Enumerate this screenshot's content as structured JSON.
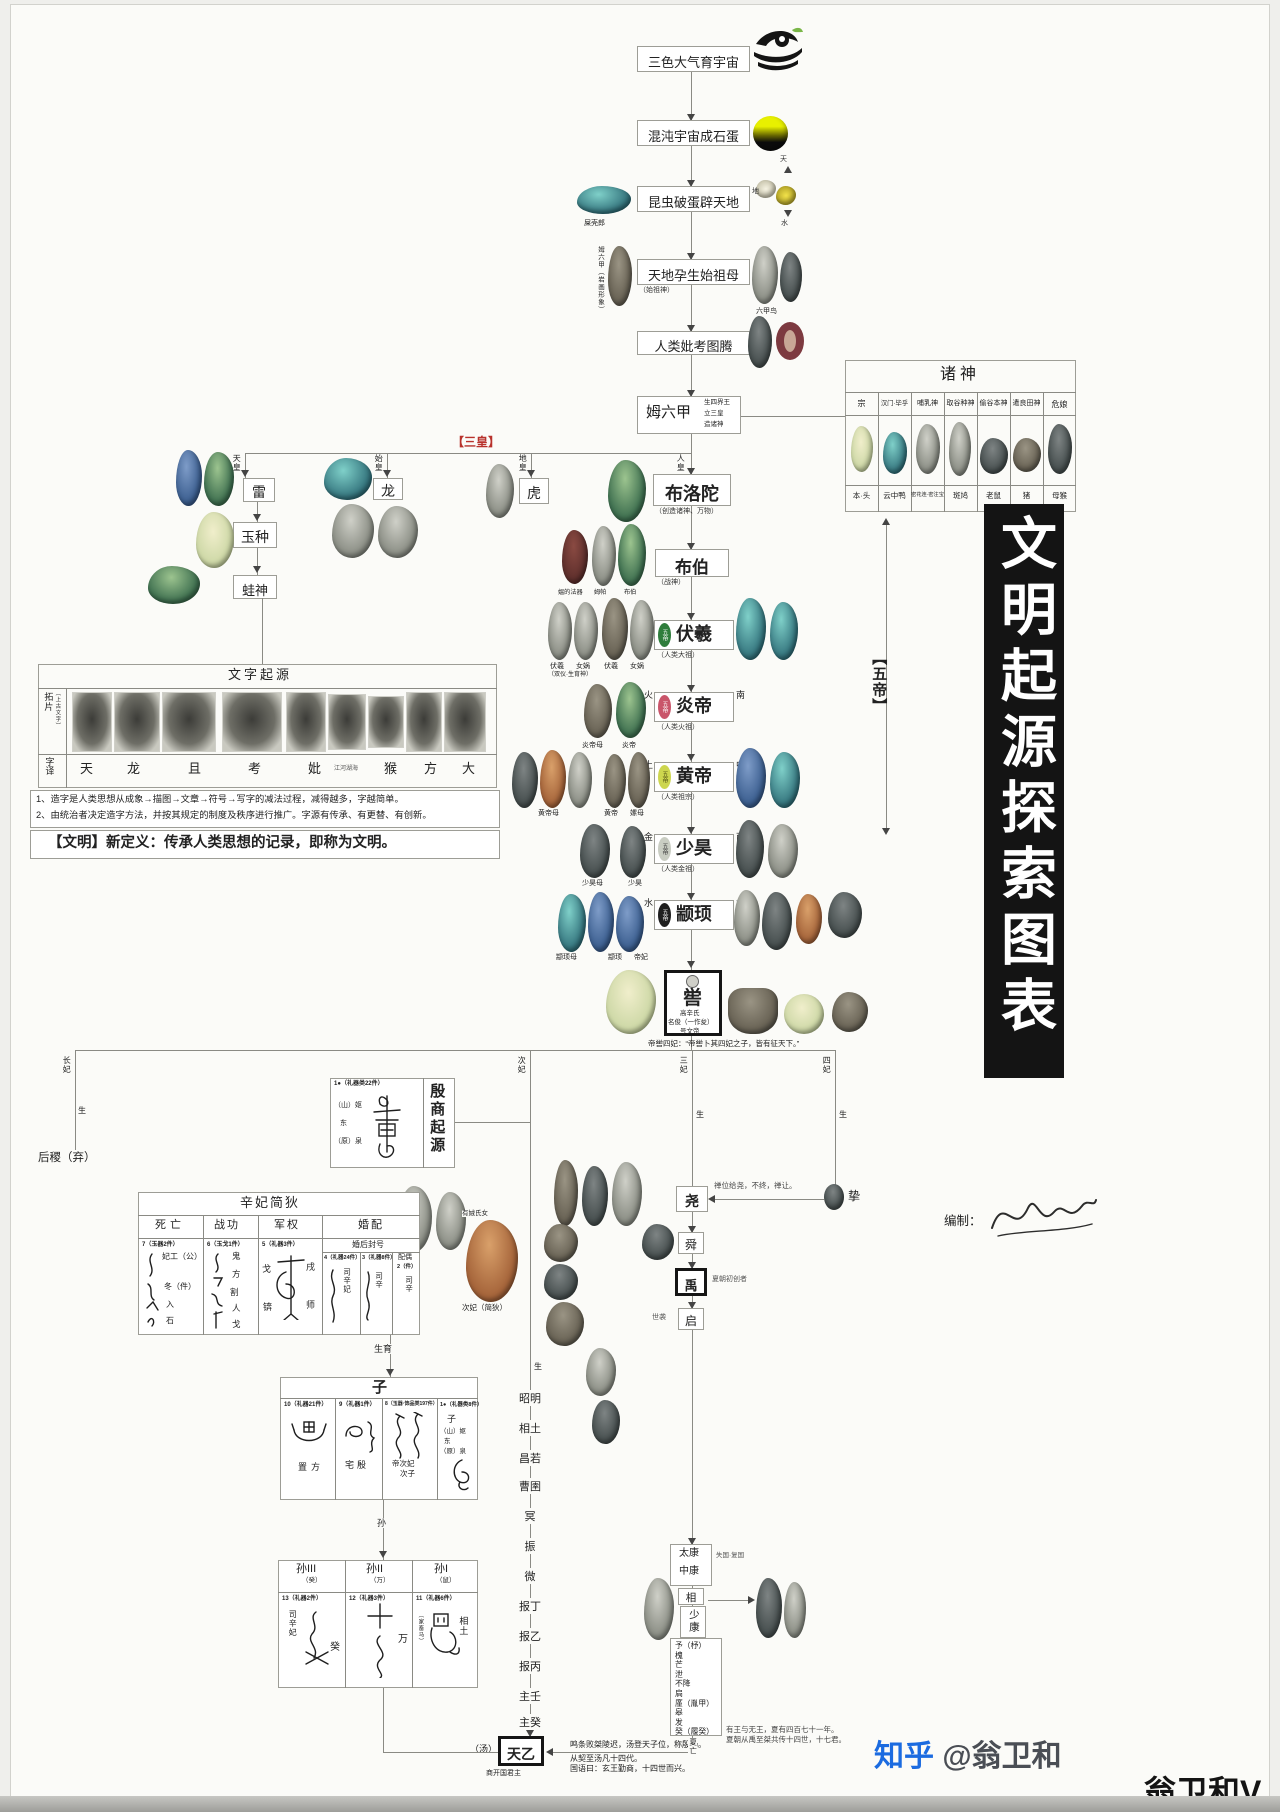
{
  "banner": {
    "title": "文明起源探索图表",
    "bg": "#141414"
  },
  "credit": {
    "label": "编制：",
    "name": "翁卫和"
  },
  "wm": {
    "zhihu": "知乎",
    "handle": "@翁卫和",
    "name": "翁卫和V"
  },
  "accents": {
    "red": "#b8322c",
    "badge_fuxi": "#2f7d3c",
    "badge_yandi": "#c9556a",
    "badge_huangdi": "#cdd64e",
    "badge_shaohao": "#c9cdc2",
    "badge_zhuanxu": "#1f1f1f"
  },
  "top": {
    "b1": "三色大气育宇宙",
    "b2": "混沌宇宙成石蛋",
    "b3": "昆虫破蛋辟天地",
    "b4": "天地孕生始祖母",
    "b4s": "（始祖神）",
    "b5": "人类妣考图腾",
    "beetle": "屎壳郎",
    "mu_cap": "姆六甲（岩画形象）",
    "bird_cap": "六甲鸟",
    "sky": "天",
    "earth": "地",
    "water": "水"
  },
  "mu": {
    "name": "姆六甲",
    "s1": "生四界王",
    "s2": "立三皇",
    "s3": "造诸神"
  },
  "sh": {
    "tag": "【三皇】",
    "tian": "天皇",
    "lei": "雷",
    "yu": "玉种",
    "wa": "蛙神",
    "shi": "始皇",
    "long": "龙",
    "di": "地皇",
    "hu": "虎",
    "ren": "人皇"
  },
  "gods": {
    "title": "诸神",
    "cols": [
      "宗",
      "汉门·毕乎",
      "哺乳神",
      "取谷种神",
      "偷谷本神",
      "遣良田神",
      "危娘"
    ],
    "rows": [
      "本·头",
      "云中鸭",
      "密花连·密注宝",
      "斑鸠",
      "老鼠",
      "猪",
      "母猴"
    ]
  },
  "ch": {
    "buluotuo": "布洛陀",
    "buluotuo_s": "（创造诸神、万物）",
    "bubo": "布伯",
    "bubo_s": "（战神）",
    "bubo_c0": "媪的法器",
    "bubo_c1": "姆帕",
    "bubo_c2": "布伯",
    "fuxi": "伏羲",
    "fuxi_s": "（人类大祖）",
    "fuxi_l": "太",
    "fuxi_r": "风",
    "fuxi_c0": "伏羲",
    "fuxi_c1": "女娲",
    "fuxi_c2": "伏羲",
    "fuxi_c3": "女娲",
    "fuxi_n": "（双仪·生育神）",
    "yandi": "炎帝",
    "yandi_s": "（人类火祖）",
    "yandi_l": "火",
    "yandi_r": "南",
    "yandi_c0": "炎帝母",
    "yandi_c1": "炎帝",
    "huangdi": "黄帝",
    "huangdi_s": "（人类祖宗）",
    "huangdi_l": "土",
    "huangdi_r": "中",
    "huangdi_c0": "黄帝母",
    "huangdi_c1": "黄帝",
    "huangdi_c2": "嫘母",
    "shaohao": "少昊",
    "shaohao_s": "（人类金祖）",
    "shaohao_l": "金",
    "shaohao_r": "西",
    "shaohao_c0": "少昊母",
    "shaohao_c1": "少昊",
    "zhuanxu": "颛顼",
    "zhuanxu_l": "水",
    "zhuanxu_r": "北",
    "zhuanxu_c0": "颛顼母",
    "zhuanxu_c1": "颛顼",
    "zhuanxu_c2": "帝妃",
    "badge": "五帝",
    "ku": "喾",
    "ku1": "高辛氏",
    "ku2": "名俊（一作夋）",
    "ku3": "号文帝",
    "kuq": "帝喾四妃：“帝喾卜其四妃之子，皆有征天下。”",
    "wudi": "【五帝】"
  },
  "sc": {
    "title": "文字起源",
    "rub": "拓片",
    "rubs": "（上古文字）",
    "tr": "字译",
    "chars": [
      "天",
      "龙",
      "且",
      "考",
      "妣",
      "江河湖海",
      "猴",
      "方",
      "大"
    ],
    "n1": "1、造字是人类思想从成象→描图→文章→符号→写字的减法过程，减得越多，字越简单。",
    "n2": "2、由统治者决定造字方法，并按其规定的制度及秩序进行推广。字源有传承、有更替、有创新。",
    "def": "【文明】新定义：传承人类思想的记录，即称为文明。"
  },
  "co": {
    "c1": "长妃",
    "c2": "次妃",
    "c3": "三妃",
    "c4": "四妃",
    "sheng": "生",
    "houji": "后稷（弃）",
    "ys": "有娀氏女",
    "jd": "次妃（简狄）",
    "zhi": "挚",
    "zn": "禅位给尧，不终，禅让。"
  },
  "yin": {
    "title": "殷商起源",
    "tag": "1●（礼器类22件）",
    "g1": "（山）妪",
    "g2": "东",
    "g3": "（原）泉"
  },
  "xf": {
    "title": "辛妃简狄",
    "h0": "死亡",
    "h1": "战功",
    "h2": "军权",
    "h3": "婚配",
    "t7": "7（玉器2件）",
    "d0": "妃工（公）",
    "d1": "冬（件）",
    "d2": "入",
    "d3": "石",
    "t6": "6（玉戈1件）",
    "w0": "鬼",
    "w1": "方",
    "w2": "割",
    "w3": "人",
    "w4": "戈",
    "t5": "5（礼器3件）",
    "a0": "戈",
    "a1": "戌",
    "a2": "锛",
    "a3": "师",
    "mh": "婚后封号",
    "t4": "4（礼器24件）",
    "m4": "司辛妃",
    "t3": "3（礼器8件）",
    "m3": "司辛",
    "mate": "配偶",
    "t2": "2（件）",
    "m2": "司辛",
    "sy": "生育"
  },
  "zi": {
    "title": "子",
    "t10": "10（礼器21件）",
    "c10": "置方",
    "t9": "9（礼器1件）",
    "c9": "宅殷",
    "t8": "8（玉器·饰品类197件）",
    "c8a": "帝次妃",
    "c8b": "次子",
    "t1": "1●（礼器类8件）",
    "c1a": "子",
    "c1b": "（山）妪",
    "c1c": "东",
    "c1d": "（原）泉",
    "sun": "孙"
  },
  "sun": {
    "h3": "孙III",
    "h3s": "（癸）",
    "h2": "孙II",
    "h2s": "（万）",
    "h1": "孙I",
    "h1s": "（鼠）",
    "t13": "13（礼器2件）",
    "c13": "司辛妃",
    "c13b": "癸",
    "t12": "12（礼器3件）",
    "c12": "万",
    "t11": "11（礼器6件）",
    "c11": "相土",
    "c11s": "（家畜马）"
  },
  "sg": {
    "list": [
      "昭明",
      "相土",
      "昌若",
      "曹圉",
      "冥",
      "振",
      "微",
      "报丁",
      "报乙",
      "报丙",
      "主壬",
      "主癸"
    ],
    "tianyi": "天乙",
    "tang": "（汤）",
    "founder": "商开国君主",
    "n1": "鸣条败桀陵迟，汤登天子位，称殷汤。",
    "n2": "从契至汤凡十四代。",
    "n3": "国语曰：玄王勤商，十四世而兴。"
  },
  "xia": {
    "yao": "尧",
    "shun": "舜",
    "shun_s": "禅位",
    "yu": "禹",
    "yu_s": "夏朝初创者",
    "qi": "启",
    "qi_s": "世袭",
    "tk": "太康",
    "zk": "中康",
    "tkn": "失国·复国",
    "xiang": "相",
    "sk": "少康",
    "desc": [
      "予（杼）",
      "槐",
      "芒",
      "泄",
      "不降",
      "扃",
      "廑（胤甲）",
      "皋",
      "发",
      "癸（履癸）"
    ],
    "fall": "夏亡",
    "n1": "有王与无王，夏有四百七十一年。",
    "n2": "夏朝从禹至桀共传十四世，十七君。"
  }
}
